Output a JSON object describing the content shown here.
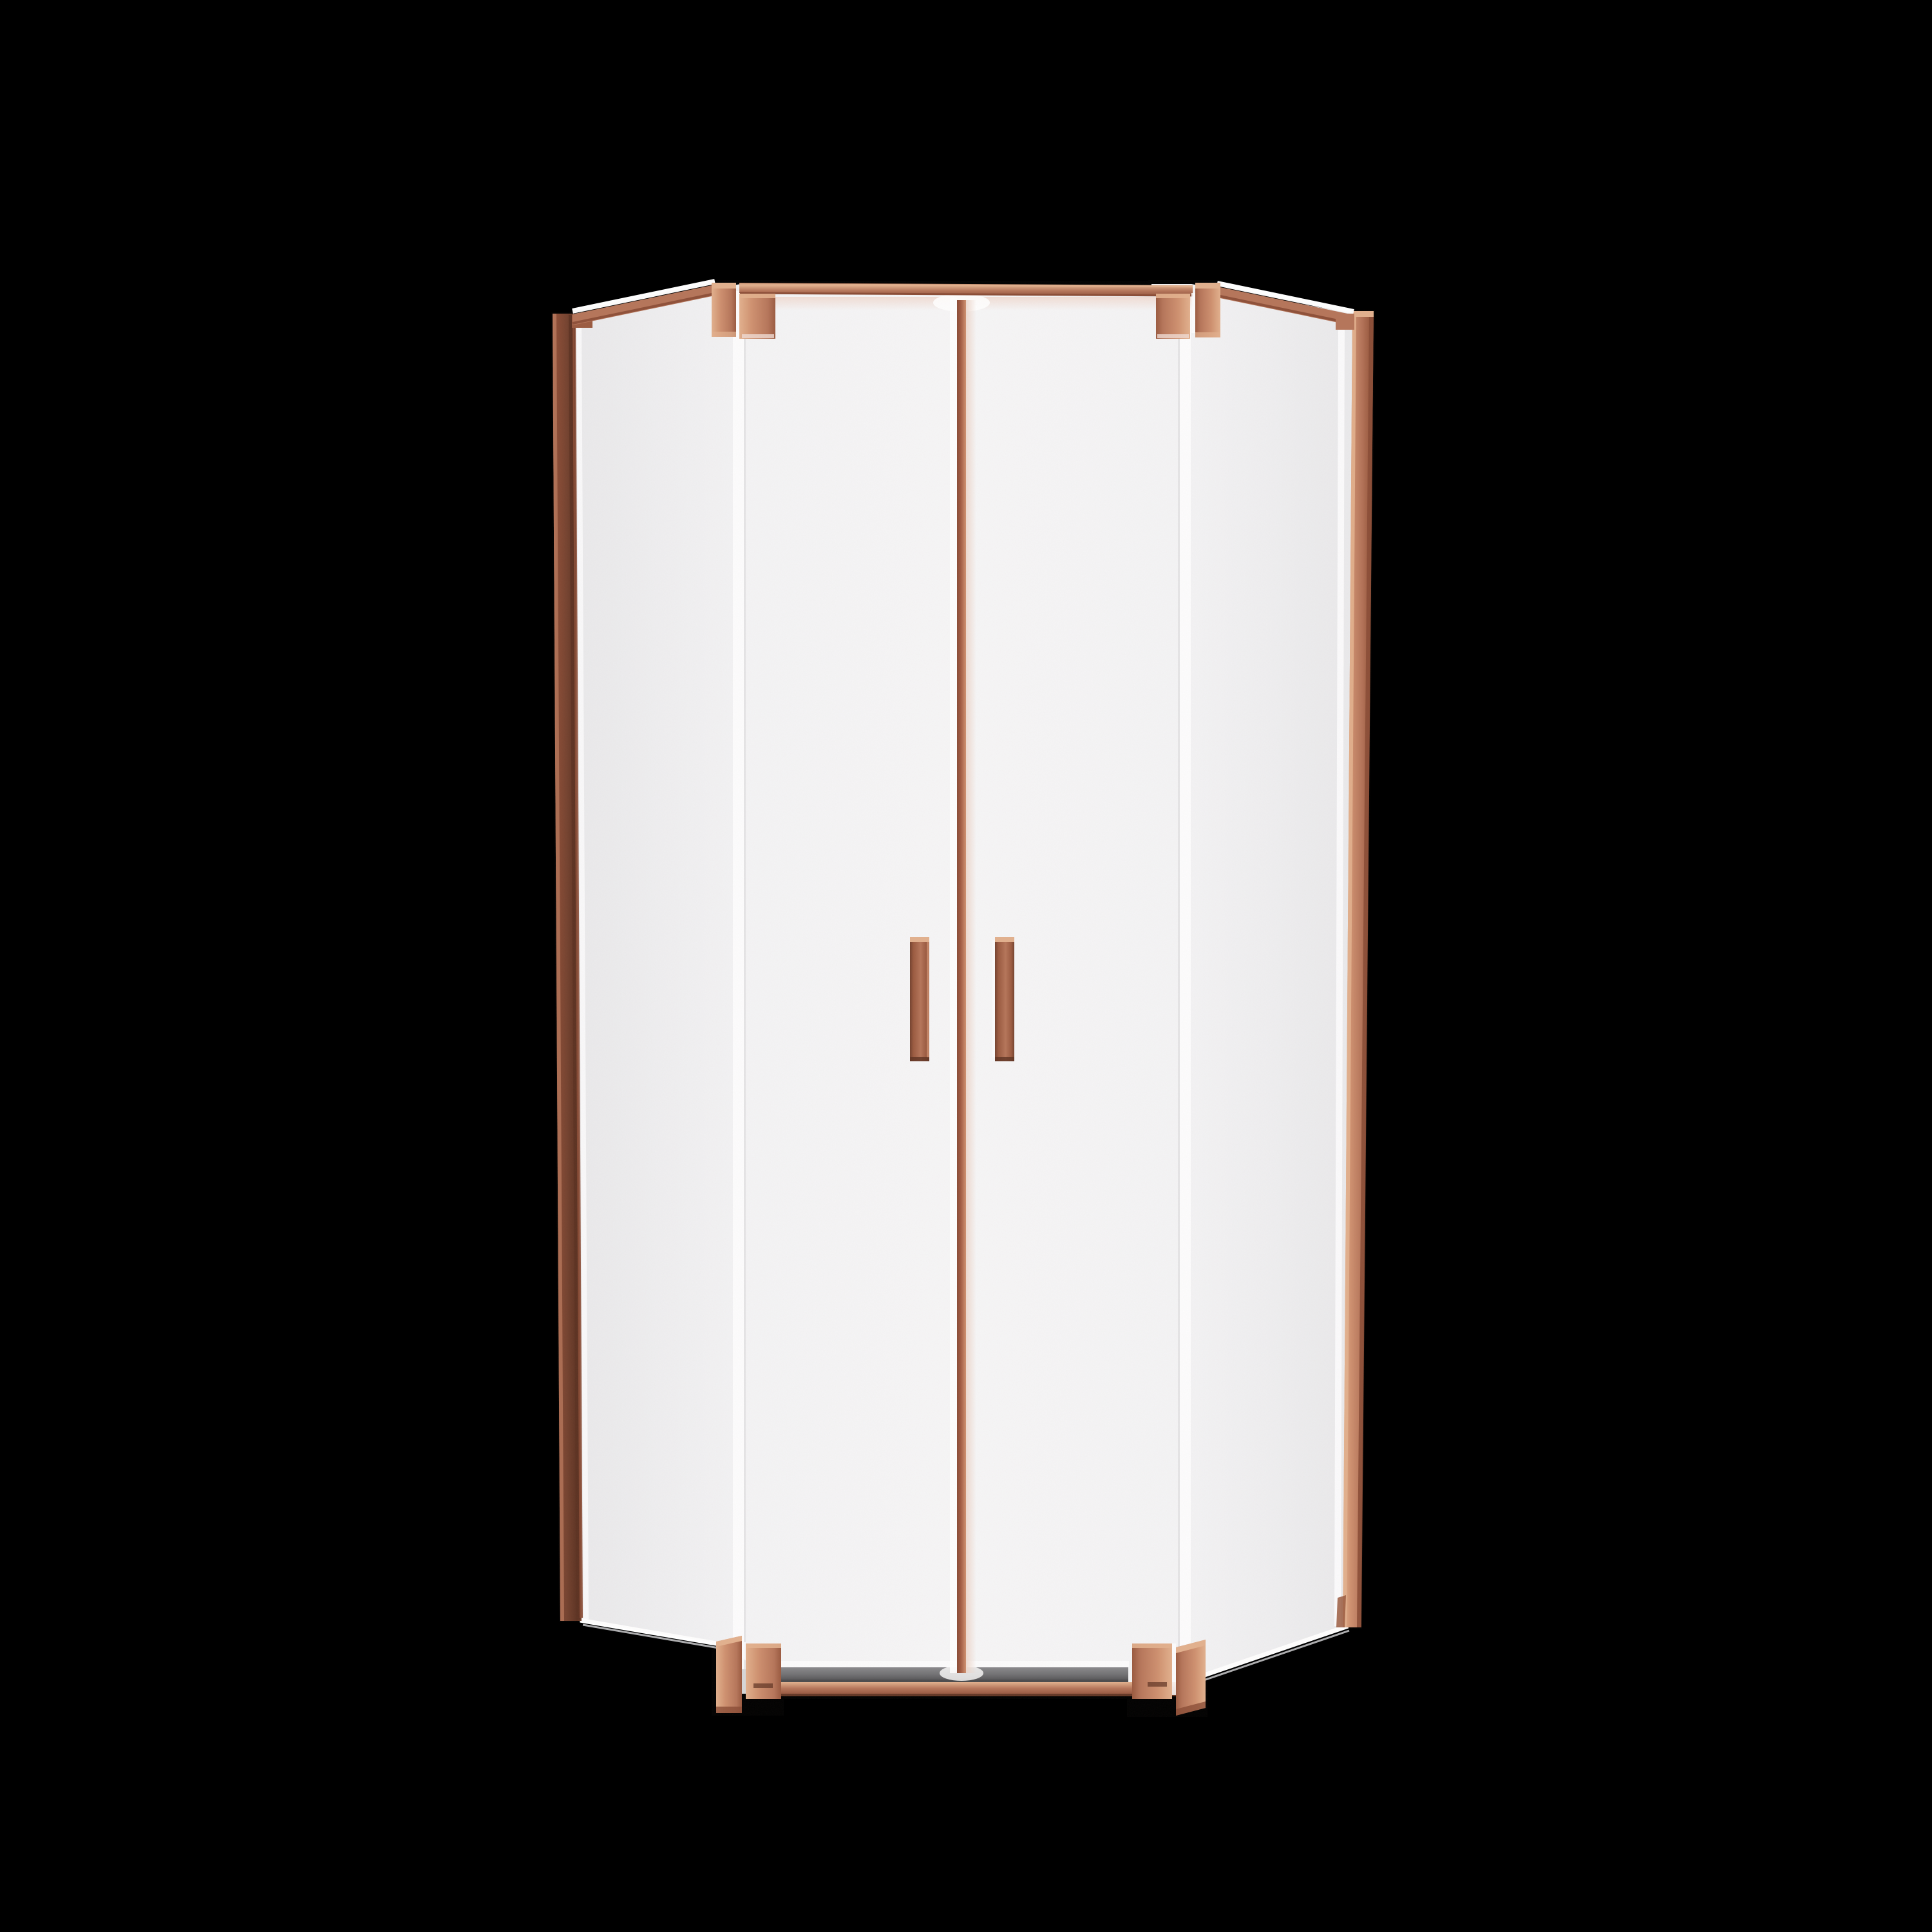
{
  "scene": {
    "subject": "neo-angle corner shower enclosure, double pivot glass doors, brushed rose-gold copper hardware",
    "background": "black",
    "glass_appearance": "bright frosted white panels"
  },
  "palette": {
    "bg": "#000000",
    "glass": "#f6f6f7",
    "glass-edge": "#eaeaec",
    "glass-mid": "#f3f3f5",
    "glass-seam": "#fdfdfe",
    "glass-line": "#d8d8da",
    "copper-bright": "#cf9170",
    "copper-light": "#e2b18e",
    "copper-mid": "#b5755a",
    "copper-deep": "#9a5a40",
    "copper-dark": "#8a4c36",
    "frame-dark": "#74422f",
    "frame-darker": "#5c3222",
    "divider-core": "#a05a42",
    "divider-halo": "#ecd6cb",
    "shadow-pink": "#f0dcd4",
    "threshold": "#707073",
    "threshold-light": "#8a8a8d",
    "threshold-dark": "#4c4c4e"
  },
  "parts": [
    "top-support-bar",
    "corner-clamp-bracket-top-left",
    "corner-clamp-bracket-top-right",
    "corner-clamp-bracket-bottom-left",
    "corner-clamp-bracket-bottom-right",
    "left-wall-profile",
    "right-wall-profile",
    "left-angled-glass-panel",
    "right-angled-glass-panel",
    "left-door-glass",
    "right-door-glass",
    "center-door-seal",
    "left-door-handle",
    "right-door-handle",
    "bottom-threshold",
    "bottom-rail"
  ]
}
